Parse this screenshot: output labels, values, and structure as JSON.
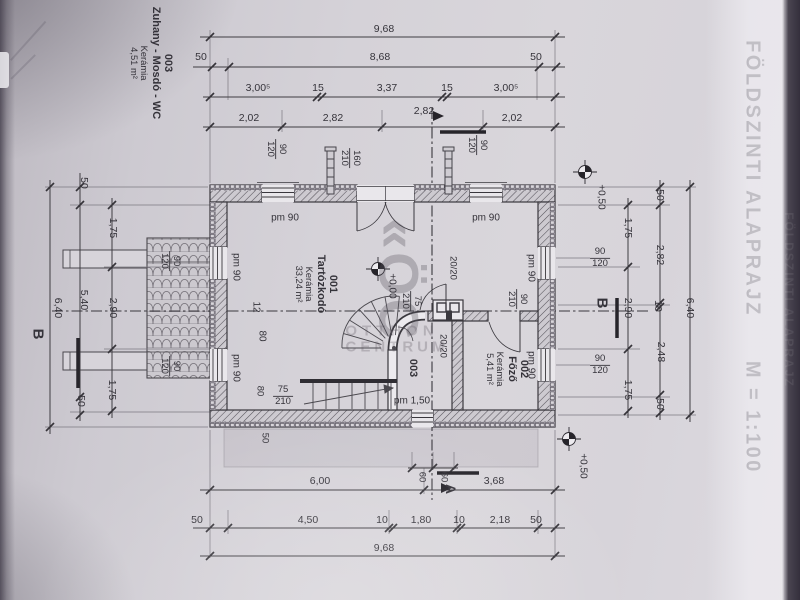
{
  "title": {
    "text": "FÖLDSZINTI ALAPRAJZ",
    "scale": "M = 1:100"
  },
  "watermark": {
    "logo": "«ÖC",
    "line1": "OTTHON",
    "line2": "CENTRUM"
  },
  "labels": [
    {
      "n": "side-room-block",
      "lines": [
        "003",
        "Zuhany - Mosdó - WC"
      ],
      "lines2": [
        "Kerámia",
        "4,51 m²"
      ],
      "x": 151,
      "y": 63,
      "r": 90,
      "s": 11,
      "b": 1
    },
    {
      "n": "room-001-label",
      "lines": [
        "001",
        "Tartózkodó"
      ],
      "lines2": [
        "Kerámia",
        "33,24 m²"
      ],
      "x": 316,
      "y": 284,
      "r": 90,
      "s": 11,
      "b": 1
    },
    {
      "n": "room-002-label",
      "lines": [
        "002",
        "Főző"
      ],
      "lines2": [
        "Kerámia",
        "5,41 m²"
      ],
      "x": 507,
      "y": 369,
      "r": 90,
      "s": 11,
      "b": 1
    },
    {
      "n": "room-003-label",
      "t": "003",
      "x": 413,
      "y": 368,
      "r": 90,
      "s": 11,
      "b": 1
    },
    {
      "n": "dim-total-top",
      "t": "9,68",
      "x": 384,
      "y": 30
    },
    {
      "n": "dim",
      "t": "50",
      "x": 201,
      "y": 58
    },
    {
      "n": "dim",
      "t": "8,68",
      "x": 380,
      "y": 58
    },
    {
      "n": "dim",
      "t": "50",
      "x": 536,
      "y": 58
    },
    {
      "n": "dim",
      "t": "3,00⁵",
      "x": 258,
      "y": 89
    },
    {
      "n": "dim",
      "t": "15",
      "x": 318,
      "y": 89
    },
    {
      "n": "dim",
      "t": "3,37",
      "x": 387,
      "y": 89
    },
    {
      "n": "dim",
      "t": "15",
      "x": 447,
      "y": 89
    },
    {
      "n": "dim",
      "t": "3,00⁵",
      "x": 506,
      "y": 89
    },
    {
      "n": "dim",
      "t": "2,02",
      "x": 249,
      "y": 119
    },
    {
      "n": "dim",
      "t": "2,82",
      "x": 333,
      "y": 119
    },
    {
      "n": "dim",
      "t": "2,82",
      "x": 424,
      "y": 112
    },
    {
      "n": "dim",
      "t": "2,02",
      "x": 512,
      "y": 119
    },
    {
      "n": "window-size",
      "frac": [
        "90",
        "120"
      ],
      "x": 276,
      "y": 149,
      "r": 90,
      "s": 9.5
    },
    {
      "n": "door-size",
      "frac": [
        "160",
        "210"
      ],
      "x": 350,
      "y": 158,
      "r": 90,
      "s": 9.5
    },
    {
      "n": "window-size",
      "frac": [
        "90",
        "120"
      ],
      "x": 477,
      "y": 145,
      "r": 90,
      "s": 9.5
    },
    {
      "n": "parapet",
      "t": "pm 90",
      "x": 285,
      "y": 218,
      "s": 10
    },
    {
      "n": "parapet",
      "t": "pm 90",
      "x": 486,
      "y": 218,
      "s": 10
    },
    {
      "n": "parapet",
      "t": "pm 90",
      "x": 236,
      "y": 267,
      "r": 90,
      "s": 10
    },
    {
      "n": "parapet",
      "t": "pm 90",
      "x": 236,
      "y": 368,
      "r": 90,
      "s": 10
    },
    {
      "n": "parapet",
      "t": "pm 90",
      "x": 531,
      "y": 268,
      "r": 90,
      "s": 10
    },
    {
      "n": "parapet",
      "t": "pm 90",
      "x": 531,
      "y": 365,
      "r": 90,
      "s": 10
    },
    {
      "n": "parapet",
      "t": "pm 1,50",
      "x": 412,
      "y": 401,
      "s": 10
    },
    {
      "n": "window-size",
      "frac": [
        "90",
        "120"
      ],
      "x": 170,
      "y": 261,
      "r": 90,
      "s": 9.5
    },
    {
      "n": "window-size",
      "frac": [
        "90",
        "120"
      ],
      "x": 170,
      "y": 366,
      "r": 90,
      "s": 9.5
    },
    {
      "n": "pillar-size",
      "t": "20/20",
      "x": 452,
      "y": 268,
      "r": 90,
      "s": 9.5
    },
    {
      "n": "pillar-size",
      "t": "20/20",
      "x": 442,
      "y": 346,
      "r": 90,
      "s": 9.5
    },
    {
      "n": "door-size",
      "frac": [
        "90",
        "210"
      ],
      "x": 517,
      "y": 299,
      "r": 90,
      "s": 9.5
    },
    {
      "n": "door-size",
      "frac": [
        "75",
        "210"
      ],
      "x": 411,
      "y": 301,
      "r": 90,
      "s": 9.5
    },
    {
      "n": "stair-note",
      "t": "12",
      "x": 256,
      "y": 307,
      "r": 90,
      "s": 10
    },
    {
      "n": "stair-note",
      "t": "80",
      "x": 262,
      "y": 336,
      "r": 90,
      "s": 10
    },
    {
      "n": "door-size",
      "frac": [
        "75",
        "210"
      ],
      "x": 283,
      "y": 396,
      "s": 9.5
    },
    {
      "n": "stair-note",
      "t": "80",
      "x": 259,
      "y": 391,
      "r": 90,
      "s": 9.5
    },
    {
      "n": "dim",
      "t": "50",
      "x": 264,
      "y": 438,
      "r": 90,
      "s": 9.5
    },
    {
      "n": "elevation",
      "t": "+0,00",
      "x": 392,
      "y": 286,
      "r": 90,
      "s": 10
    },
    {
      "n": "elevation",
      "t": "+0,50",
      "x": 601,
      "y": 197,
      "r": 90,
      "s": 10
    },
    {
      "n": "elevation",
      "t": "+0,50",
      "x": 583,
      "y": 466,
      "r": 90,
      "s": 10
    },
    {
      "n": "section-letter-b",
      "t": "B",
      "x": 37,
      "y": 334,
      "r": 90,
      "s": 15,
      "b": 1
    },
    {
      "n": "section-letter-b",
      "t": "B",
      "x": 601,
      "y": 303,
      "r": 90,
      "s": 15,
      "b": 1
    },
    {
      "n": "section-letter-a",
      "t": "A",
      "x": 450,
      "y": 489,
      "r": 90,
      "s": 14,
      "b": 1
    },
    {
      "n": "dim",
      "t": "6,00",
      "x": 320,
      "y": 482
    },
    {
      "n": "dim",
      "t": "3,68",
      "x": 494,
      "y": 482
    },
    {
      "n": "dim",
      "t": "50",
      "x": 197,
      "y": 521
    },
    {
      "n": "dim",
      "t": "4,50",
      "x": 308,
      "y": 521
    },
    {
      "n": "dim",
      "t": "10",
      "x": 382,
      "y": 521
    },
    {
      "n": "dim",
      "t": "1,80",
      "x": 421,
      "y": 521
    },
    {
      "n": "dim",
      "t": "10",
      "x": 459,
      "y": 521
    },
    {
      "n": "dim",
      "t": "2,18",
      "x": 500,
      "y": 521
    },
    {
      "n": "dim",
      "t": "50",
      "x": 536,
      "y": 521
    },
    {
      "n": "dim-total-bottom",
      "t": "9,68",
      "x": 384,
      "y": 549
    },
    {
      "n": "dim",
      "t": "60",
      "x": 421,
      "y": 477,
      "r": 90,
      "s": 9.5
    },
    {
      "n": "dim",
      "t": "60",
      "x": 443,
      "y": 477,
      "r": 90,
      "s": 9.5
    },
    {
      "n": "dim",
      "t": "6,40",
      "x": 57,
      "y": 308,
      "r": 90
    },
    {
      "n": "dim",
      "t": "50",
      "x": 83,
      "y": 183,
      "r": 90
    },
    {
      "n": "dim",
      "t": "5,40",
      "x": 83,
      "y": 300,
      "r": 90
    },
    {
      "n": "dim",
      "t": "50",
      "x": 80,
      "y": 401,
      "r": 90
    },
    {
      "n": "dim",
      "t": "1,75",
      "x": 112,
      "y": 228,
      "r": 90
    },
    {
      "n": "dim",
      "t": "2,90",
      "x": 112,
      "y": 308,
      "r": 90
    },
    {
      "n": "dim",
      "t": "1,75",
      "x": 111,
      "y": 390,
      "r": 90
    },
    {
      "n": "dim",
      "t": "1,75",
      "x": 627,
      "y": 228,
      "r": 90
    },
    {
      "n": "dim",
      "t": "2,90",
      "x": 627,
      "y": 308,
      "r": 90
    },
    {
      "n": "dim",
      "t": "1,75",
      "x": 627,
      "y": 390,
      "r": 90
    },
    {
      "n": "dim",
      "t": "50",
      "x": 659,
      "y": 195,
      "r": 90
    },
    {
      "n": "dim",
      "t": "2,82",
      "x": 659,
      "y": 255,
      "r": 90
    },
    {
      "n": "dim",
      "t": "10",
      "x": 657,
      "y": 306,
      "r": 90
    },
    {
      "n": "dim",
      "t": "2,48",
      "x": 660,
      "y": 352,
      "r": 90
    },
    {
      "n": "dim",
      "t": "50",
      "x": 659,
      "y": 404,
      "r": 90
    },
    {
      "n": "dim",
      "t": "6,40",
      "x": 689,
      "y": 308,
      "r": 90
    },
    {
      "n": "window-size",
      "frac": [
        "90",
        "120"
      ],
      "x": 600,
      "y": 258,
      "s": 9.5
    },
    {
      "n": "window-size",
      "frac": [
        "90",
        "120"
      ],
      "x": 600,
      "y": 365,
      "s": 9.5
    }
  ]
}
